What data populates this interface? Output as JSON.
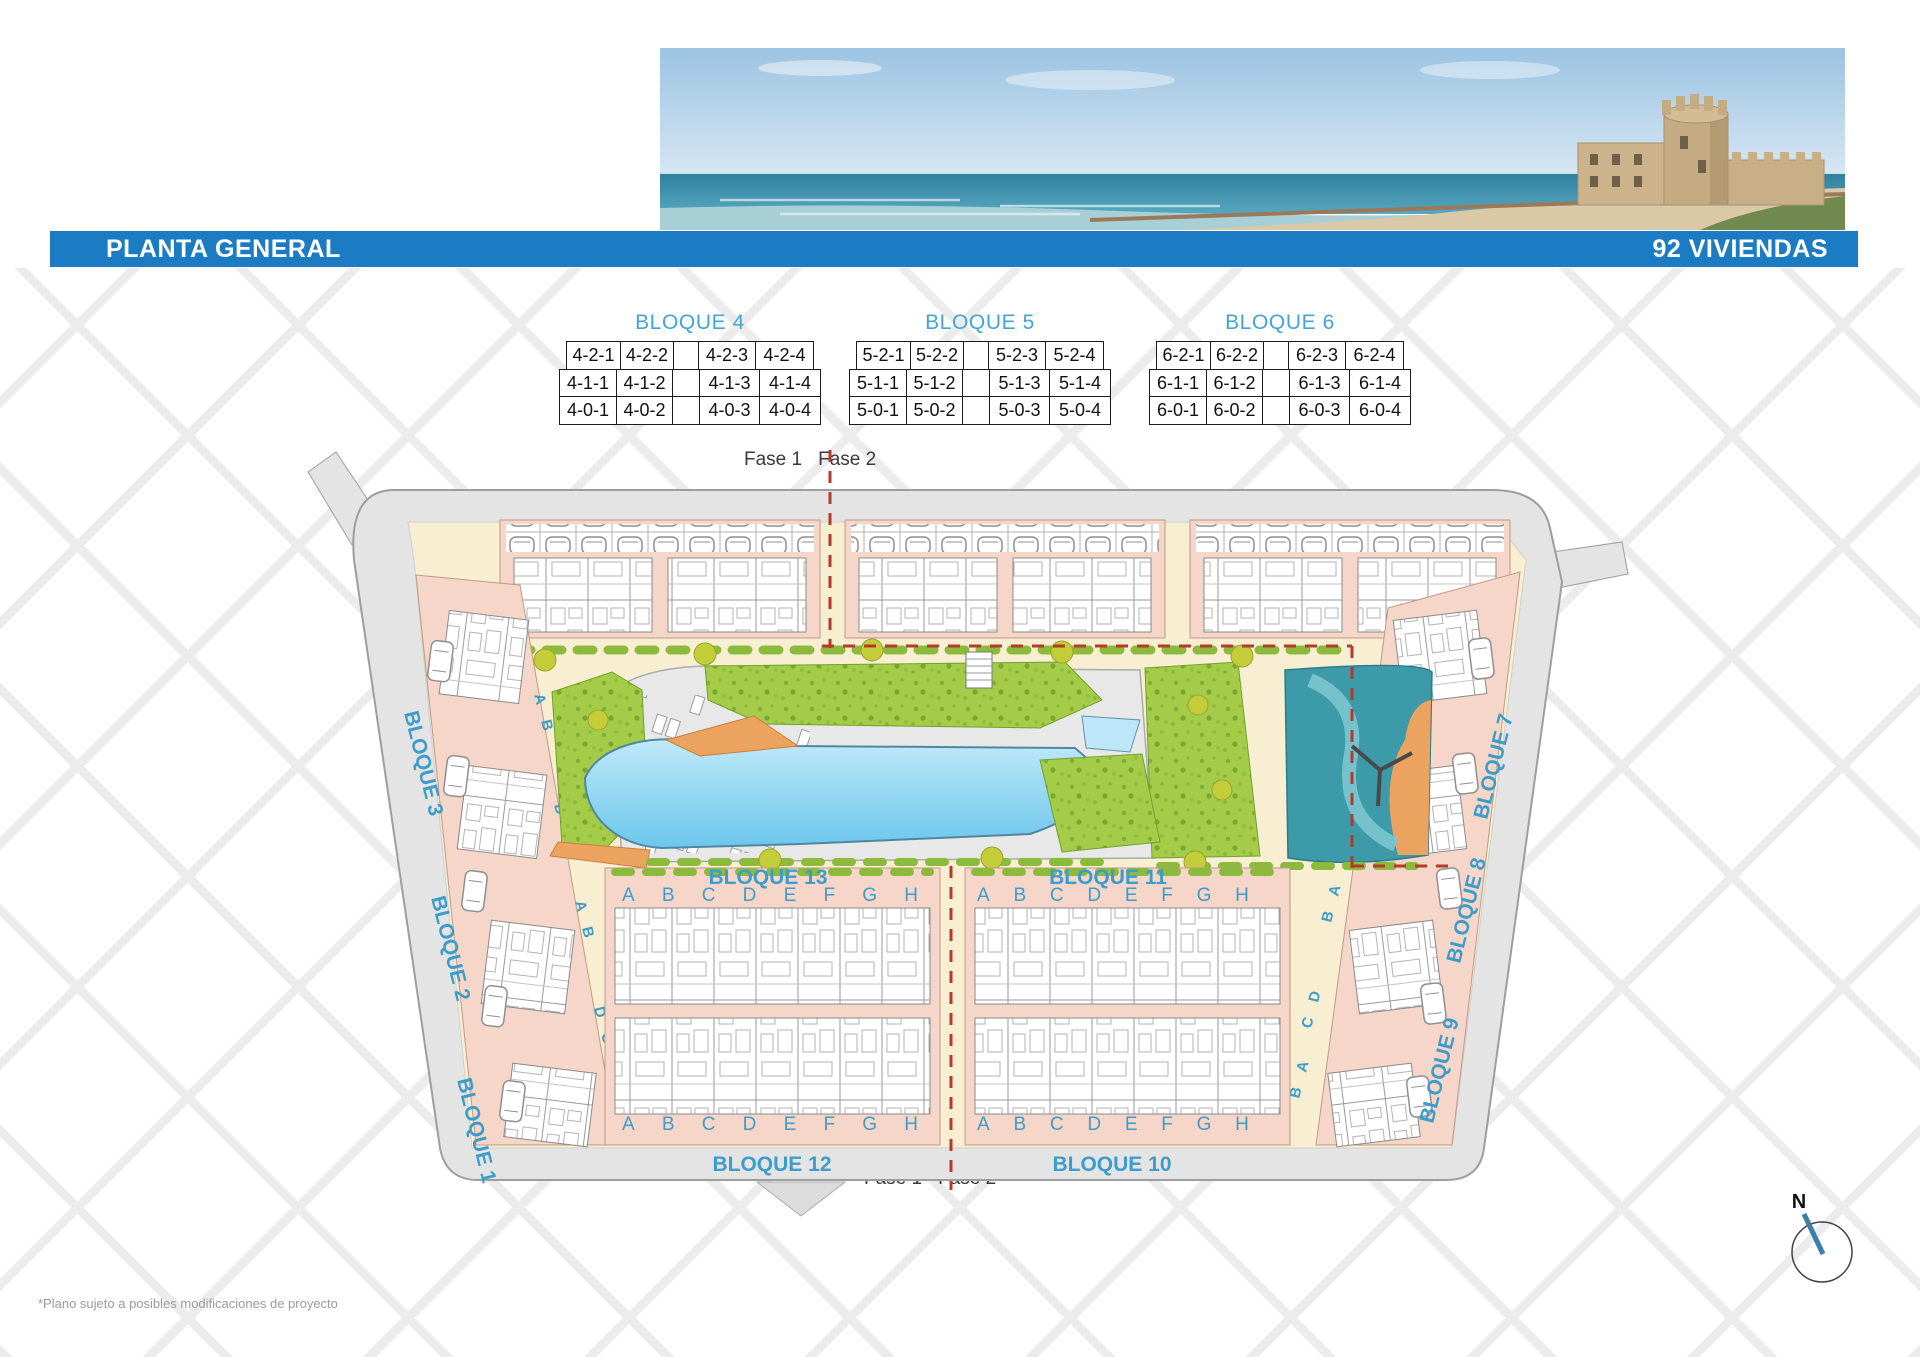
{
  "header": {
    "title": "PLANTA GENERAL",
    "badge": "92 VIVIENDAS"
  },
  "tables": [
    {
      "title": "BLOQUE 4",
      "rows": [
        [
          "4-2-1",
          "4-2-2",
          "",
          "4-2-3",
          "4-2-4"
        ],
        [
          "4-1-1",
          "4-1-2",
          "",
          "4-1-3",
          "4-1-4"
        ],
        [
          "4-0-1",
          "4-0-2",
          "",
          "4-0-3",
          "4-0-4"
        ]
      ]
    },
    {
      "title": "BLOQUE 5",
      "rows": [
        [
          "5-2-1",
          "5-2-2",
          "",
          "5-2-3",
          "5-2-4"
        ],
        [
          "5-1-1",
          "5-1-2",
          "",
          "5-1-3",
          "5-1-4"
        ],
        [
          "5-0-1",
          "5-0-2",
          "",
          "5-0-3",
          "5-0-4"
        ]
      ]
    },
    {
      "title": "BLOQUE 6",
      "rows": [
        [
          "6-2-1",
          "6-2-2",
          "",
          "6-2-3",
          "6-2-4"
        ],
        [
          "6-1-1",
          "6-1-2",
          "",
          "6-1-3",
          "6-1-4"
        ],
        [
          "6-0-1",
          "6-0-2",
          "",
          "6-0-3",
          "6-0-4"
        ]
      ]
    }
  ],
  "plan": {
    "phase": {
      "fase1": "Fase 1",
      "fase2": "Fase 2"
    },
    "blocks": {
      "b1": "BLOQUE 1",
      "b2": "BLOQUE 2",
      "b3": "BLOQUE 3",
      "b7": "BLOQUE 7",
      "b8": "BLOQUE 8",
      "b9": "BLOQUE 9",
      "b10": "BLOQUE 10",
      "b11": "BLOQUE 11",
      "b12": "BLOQUE 12",
      "b13": "BLOQUE 13"
    },
    "unit_letters": [
      "A",
      "B",
      "C",
      "D",
      "E",
      "F",
      "G",
      "H"
    ],
    "side_letter_groups": [
      [
        "A",
        "B"
      ],
      [
        "D",
        "C"
      ],
      [
        "A",
        "B"
      ],
      [
        "D",
        "C"
      ],
      [
        "A",
        "B"
      ]
    ],
    "compass": {
      "north": "N"
    }
  },
  "footnote": "*Plano sujeto a posibles modificaciones de proyecto",
  "colors": {
    "bar_blue": "#1B7CC4",
    "label_blue": "#3E9CCB",
    "table_title_blue": "#45A4D6",
    "salmon": "#F5D6C9",
    "cream": "#F8EFD2",
    "road_gray": "#E4E4E4",
    "green": "#A5CC49",
    "pool_blue": "#6CC6EC",
    "teal": "#3D9AA8",
    "orange": "#EBA35F",
    "phase_red": "#B43A2A"
  }
}
